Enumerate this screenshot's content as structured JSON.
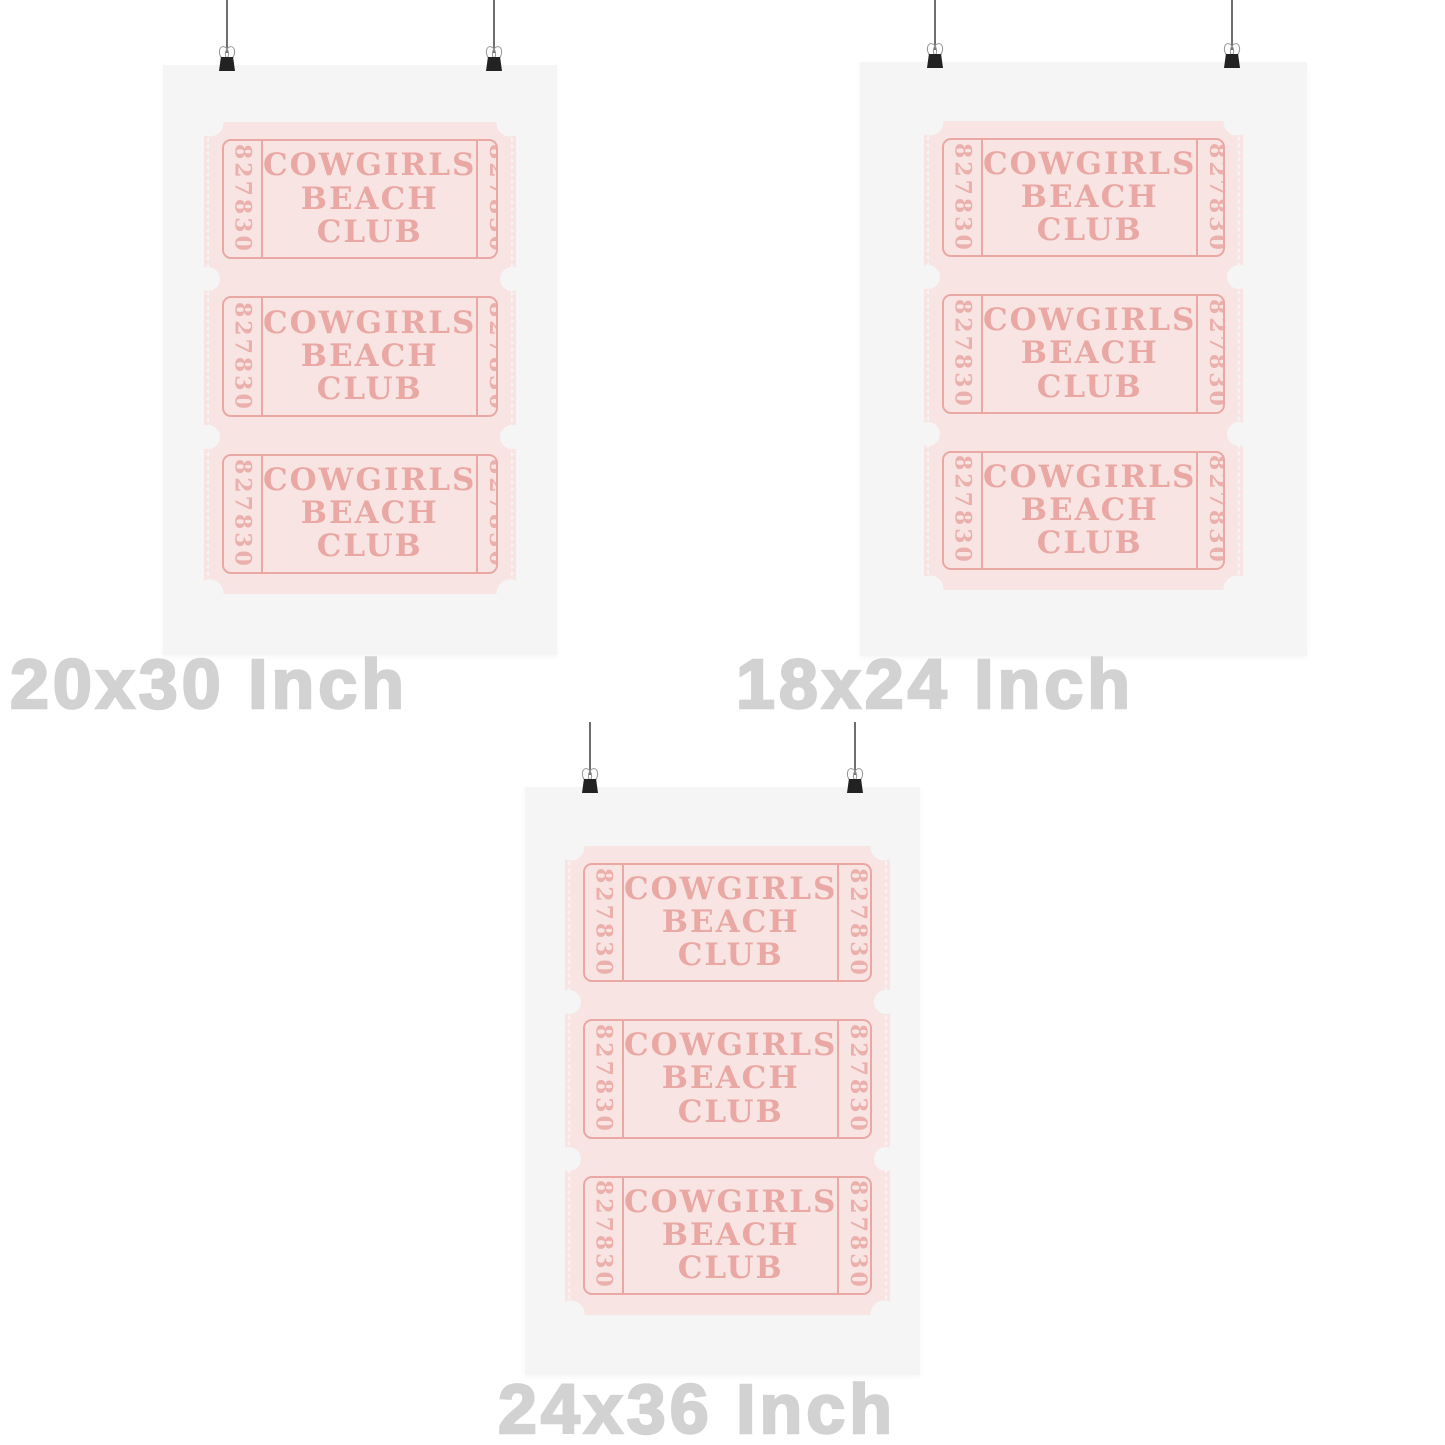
{
  "ticket": {
    "serial": "827830",
    "title_lines": [
      "COWGIRLS",
      "BEACH",
      "CLUB"
    ]
  },
  "posters": [
    {
      "id": "20x30",
      "label": "20x30 Inch"
    },
    {
      "id": "18x24",
      "label": "18x24 Inch"
    },
    {
      "id": "24x36",
      "label": "24x36 Inch"
    }
  ],
  "icons": {
    "binder_clip": "black trapezoid clip with two silver wire handles",
    "hanging_wire": "thin vertical gray line"
  },
  "colors": {
    "page_bg": "#ffffff",
    "poster_bg": "#f5f5f6",
    "ticket_paper": "#f8e5e3",
    "ticket_ink": "#e9a8a4",
    "label_gray": "#d2d2d2",
    "clip_black": "#222222",
    "clip_silver": "#949494",
    "wire_gray": "#6e6e6e"
  }
}
